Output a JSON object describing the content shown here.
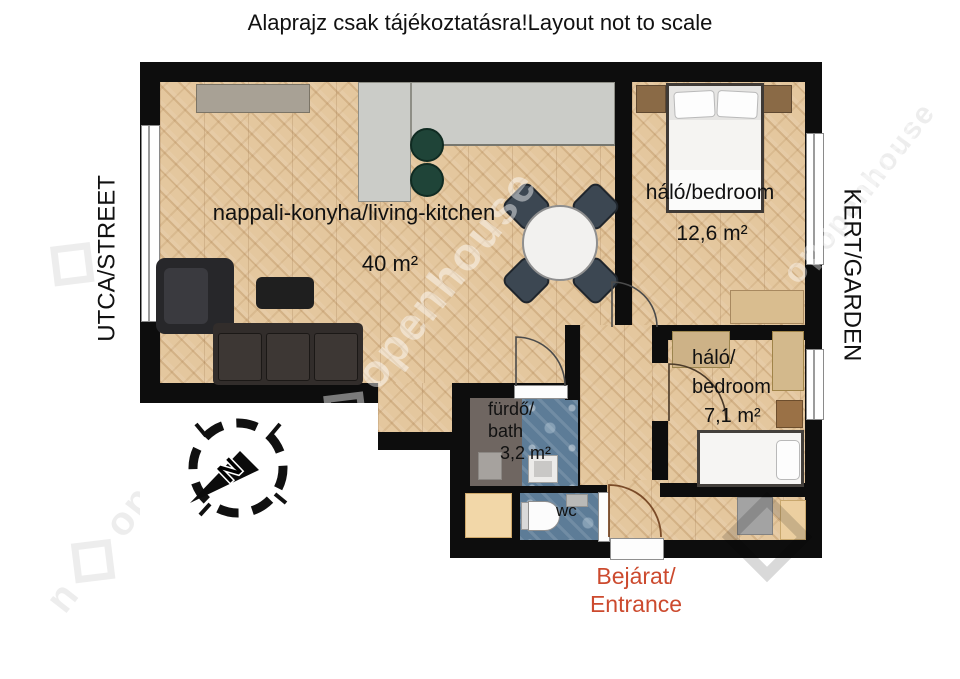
{
  "title": "Alaprajz csak tájékoztatásra!Layout not to scale",
  "labels": {
    "street": "UTCA/STREET",
    "garden": "KERT/GARDEN",
    "entrance_line1": "Bejárat/",
    "entrance_line2": "Entrance",
    "compass_north": "N",
    "watermark": "openhouse"
  },
  "rooms": {
    "living": {
      "name": "nappali-konyha/living-kitchen",
      "area": "40 m²"
    },
    "bedroom1": {
      "name": "háló/bedroom",
      "area": "12,6 m²"
    },
    "bedroom2": {
      "name_line1": "háló/",
      "name_line2": "bedroom",
      "area": "7,1 m²"
    },
    "bath": {
      "name_line1": "fürdő/",
      "name_line2": "bath",
      "area": "3,2 m²"
    },
    "wc": {
      "name": "wc"
    }
  },
  "colors": {
    "wall": "#0d0d0d",
    "wood": "#e4c79e",
    "tile": "#5d7c97",
    "bathgrey": "#6f6661",
    "counter": "#cbccc8",
    "entrance": "#cc4a2e"
  }
}
